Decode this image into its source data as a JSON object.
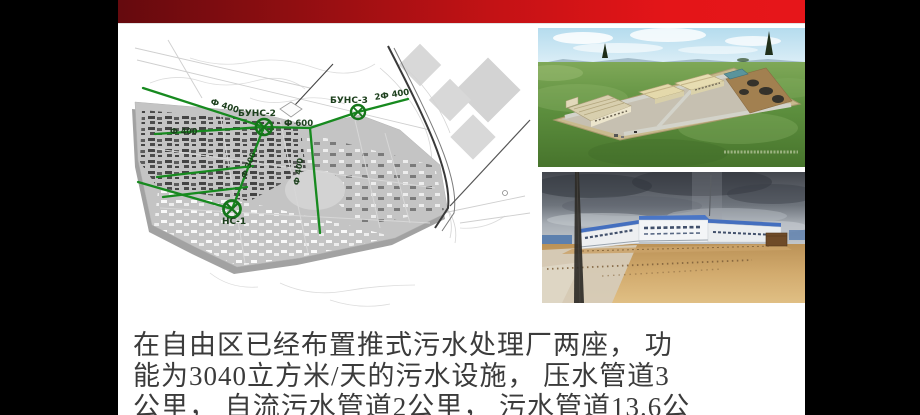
{
  "slide": {
    "banner": {
      "gradient_left": "#650a0e",
      "gradient_right": "#e41518"
    },
    "body_text": {
      "color": "#3b3b3b",
      "lines": [
        "在自由区已经布置推式污水处理厂两座， 功",
        "能为3040立方米/天的污水设施， 压水管道3",
        "公里， 自流污水管道2公里， 污水管道13.6公"
      ]
    }
  },
  "map": {
    "pipe_color": "#178a1f",
    "label_color": "#1d401d",
    "stations": [
      {
        "label": "БУНС-2"
      },
      {
        "label": "БУНС-3"
      },
      {
        "label": "НС-1"
      }
    ],
    "pipe_labels": [
      {
        "label": "Ф 400"
      },
      {
        "label": "Ф 400"
      },
      {
        "label": "Ф 600"
      },
      {
        "label": "2Ф 400"
      },
      {
        "label": "Ф 300"
      },
      {
        "label": "Ф 400"
      }
    ]
  }
}
